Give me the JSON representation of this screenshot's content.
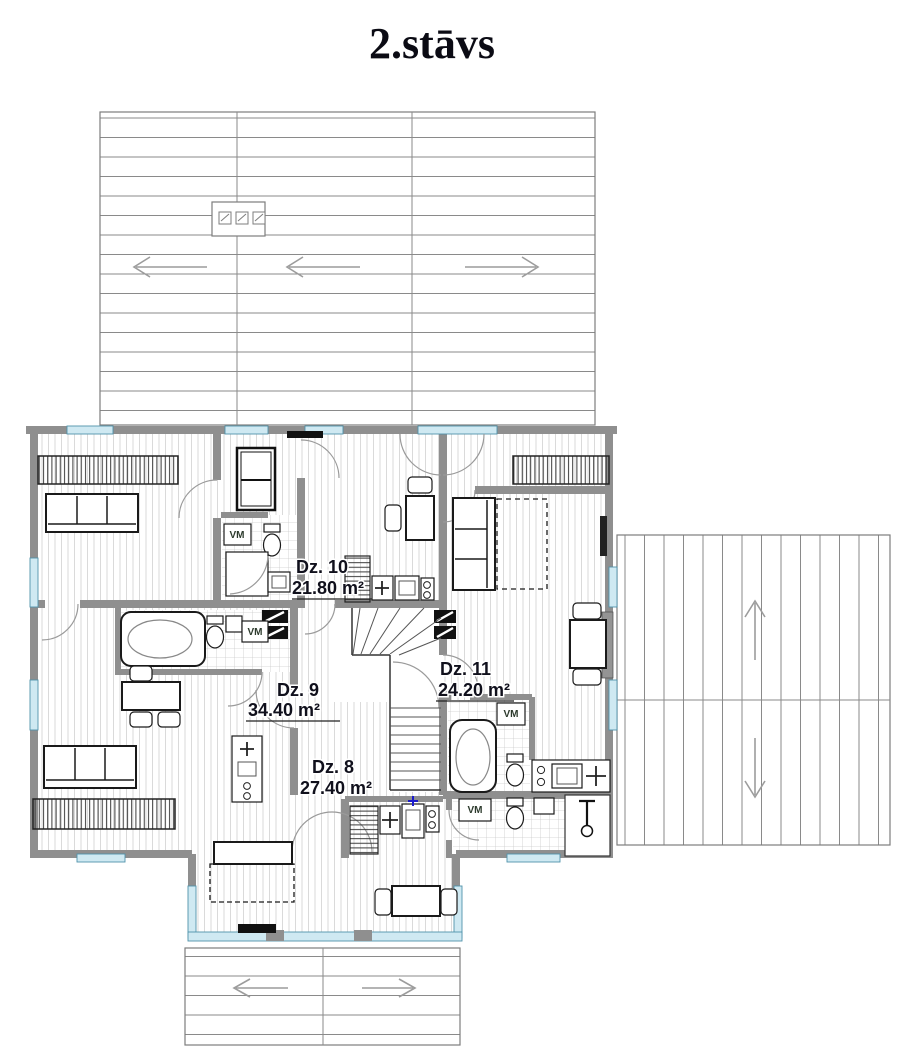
{
  "page": {
    "title": "2.stāvs"
  },
  "floorplan": {
    "rooms": [
      {
        "id": "dz10",
        "name": "Dz. 10",
        "area": "21.80 m²"
      },
      {
        "id": "dz9",
        "name": "Dz. 9",
        "area": "34.40 m²"
      },
      {
        "id": "dz11",
        "name": "Dz. 11",
        "area": "24.20 m²"
      },
      {
        "id": "dz8",
        "name": "Dz. 8",
        "area": "27.40 m²"
      }
    ],
    "appliance_label": "VM",
    "roofs": [
      {
        "id": "top-roof",
        "hatch": "horizontal",
        "arrows": [
          "left",
          "left",
          "right"
        ]
      },
      {
        "id": "right-roof",
        "hatch": "vertical",
        "arrows": [
          "up",
          "down"
        ]
      },
      {
        "id": "bottom-roof",
        "hatch": "horizontal",
        "arrows": [
          "left",
          "right"
        ]
      }
    ],
    "colors": {
      "wall": "#8f8f8f",
      "window_glass": "#cfe9f2",
      "window_frame": "#4f93ab",
      "floor_hatch": "#d6d6d6",
      "roof_line": "#8a8a8a",
      "slope_arrow": "#9c9c9c",
      "label_text": "#10101c",
      "faucet_mark": "#1a1acc"
    }
  }
}
